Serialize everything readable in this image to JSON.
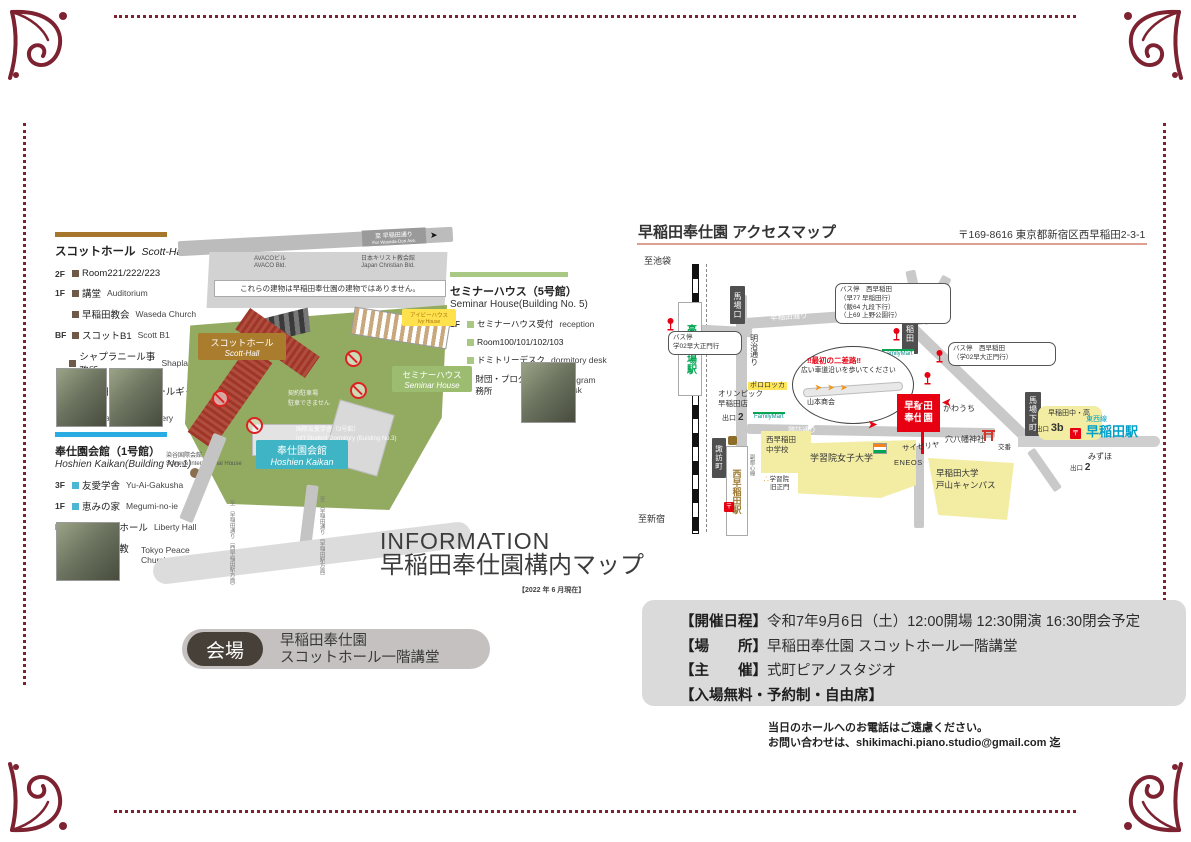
{
  "page": {
    "accent": "#7d2231"
  },
  "campus": {
    "legend_scott": {
      "title_ja": "スコットホール",
      "title_en": "Scott-Hall",
      "items": [
        {
          "floor": "2F",
          "ja": "Room221/222/223",
          "en": ""
        },
        {
          "floor": "1F",
          "ja": "講堂",
          "en": "Auditorium"
        },
        {
          "floor": "",
          "ja": "早稲田教会",
          "en": "Waseda Church"
        },
        {
          "floor": "BF",
          "ja": "スコットB1",
          "en": "Scott B1"
        },
        {
          "floor": "",
          "ja": "シャプラニール事務所",
          "en": "Shaplaneer"
        },
        {
          "floor": "",
          "ja": "早稲田スコットホールギャラリー",
          "en": "Waseda scott hall gallery"
        }
      ]
    },
    "legend_hoshien": {
      "title_ja": "奉仕園会館（1号館）",
      "title_en": "Hoshien Kaikan(Building No.1)",
      "items": [
        {
          "floor": "3F",
          "ja": "友愛学舎",
          "en": "Yu-Ai-Gakusha"
        },
        {
          "floor": "1F",
          "ja": "恵みの家",
          "en": "Megumi-no-ie"
        },
        {
          "floor": "BF",
          "ja": "リバティホール",
          "en": "Liberty Hall"
        },
        {
          "floor": "",
          "ja": "東京平和教会",
          "en": "Tokyo Peace Church"
        }
      ]
    },
    "legend_seminar": {
      "title_ja": "セミナーハウス（5号館）",
      "title_en": "Seminar House(Building No. 5)",
      "items": [
        {
          "floor": "1F",
          "ja": "セミナーハウス受付",
          "en": "reception"
        },
        {
          "floor": "",
          "ja": "Room100/101/102/103",
          "en": ""
        },
        {
          "floor": "",
          "ja": "ドミトリーデスク",
          "en": "dormitory desk"
        },
        {
          "floor": "",
          "ja": "財団・プログラム事務所",
          "en": "program desk"
        }
      ]
    },
    "map": {
      "note": "これらの建物は早稲田奉仕園の建物ではありません。",
      "avaco_ja": "AVACOビル",
      "avaco_en": "AVACO Bld.",
      "jcb_ja": "日本キリスト教会館",
      "jcb_en": "Japan Christian Bld.",
      "scott_ja": "スコットホール",
      "scott_en": "Scott-Hall",
      "seminar_ja": "セミナーハウス",
      "seminar_en": "Seminar House",
      "hoshien_ja": "奉仕園会館",
      "hoshien_en": "Hoshien Kaikan",
      "ivy_ja": "アイビーハウス",
      "ivy_en": "Ivy House",
      "dorm_ja": "国際友愛学舎（3号館）",
      "dorm_en": "Int'l Student Dormitory (Building No.3)",
      "someya_ja": "染谷国際会館",
      "someya_en": "Someya International House",
      "parking_l1": "契約駐車場",
      "parking_l2": "駐車できません",
      "sign_top_ja": "至 早稲田通り",
      "sign_top_en": "For Waseda-Dori Ave.",
      "sign_sw": "至 早稲田通り（西早稲田駅方面）",
      "sign_se": "至 早稲田通り（早稲田駅方面）"
    },
    "info_heading": "INFORMATION",
    "info_title": "早稲田奉仕園構内マップ",
    "as_of": "【2022 年 6 月現在】",
    "venue": {
      "badge": "会場",
      "line1": "早稲田奉仕園",
      "line2": "スコットホール一階講堂"
    }
  },
  "access": {
    "title": "早稲田奉仕園 アクセスマップ",
    "address": "〒169-8616 東京都新宿区西早稲田2-3-1",
    "map": {
      "to_ikebukuro": "至池袋",
      "to_shinjuku": "至新宿",
      "takadanobaba": "高田馬場駅",
      "babaguchi": "馬場口",
      "meiji_dori": "明治通り",
      "bus1_l1": "バス停",
      "bus1_l2": "学02早大正門行",
      "bus2_l1": "バス停　西早稲田",
      "bus2_l2": "（早77 早稲田行）",
      "bus2_l3": "（飯64 九段下行）",
      "bus2_l4": "（上69 上野公園行）",
      "nishiwaseda_x": "西早稲田",
      "bus3_l1": "バス停　西早稲田",
      "bus3_l2": "（学02早大正門行）",
      "familymart": "FamilyMart",
      "waseda_dori": "早稲田通り",
      "suwa_dori": "諏訪通り",
      "bubble_l1": "‼最初の二差路‼",
      "bubble_l2": "広い車道沿いを歩いてください",
      "yamamoto": "山本商会",
      "pororocca": "ポロロッカ",
      "olympic_l1": "オリンピック",
      "olympic_l2": "早稲田店",
      "exit": "出口",
      "exit2": "2",
      "exit3b": "3b",
      "suwacho": "諏訪町",
      "nishiwaseda_sta": "西早稲田駅",
      "fukutoshin": "副都心線",
      "post_mark": "〒",
      "nwjh_l1": "西早稲田",
      "nwjh_l2": "中学校",
      "gate_l1": "学習院",
      "gate_l2": "旧正門",
      "gakushuin": "学習院女子大学",
      "toyama_l1": "早稲田大学",
      "toyama_l2": "戸山キャンパス",
      "hoshien_l1": "早稲田",
      "hoshien_l2": "奉仕園",
      "kawauchi": "かわうち",
      "anahachiman": "穴八幡神社",
      "koban": "交番",
      "saizeriya": "サイゼリヤ",
      "eneos": "ENEOS",
      "babashitacho": "馬場下町",
      "waseda_jh": "早稲田中・高",
      "tozai": "東西線",
      "waseda_sta": "早稲田駅",
      "mizuho": "みずほ"
    }
  },
  "event": {
    "l1_label": "【開催日程】",
    "l1_text": "令和7年9月6日（土）12:00開場 12:30開演 16:30閉会予定",
    "l2_label": "【場　　所】",
    "l2_text": "早稲田奉仕園 スコットホール一階講堂",
    "l3_label": "【主　　催】",
    "l3_text": "式町ピアノスタジオ",
    "l4_label": "【入場無料・予約制・自由席】",
    "contact1": "当日のホールへのお電話はご遠慮ください。",
    "contact2": "お問い合わせは、shikimachi.piano.studio@gmail.com 迄"
  }
}
